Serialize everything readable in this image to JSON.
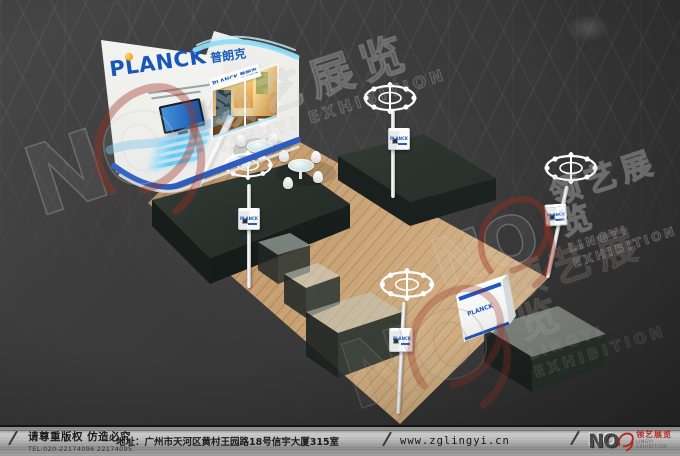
{
  "booth": {
    "brand": "PLANCK",
    "brand_cn": "普朗克"
  },
  "watermark": {
    "no": "NO",
    "one": "1",
    "cn": "领艺展览",
    "en": "LINGYI EXHIBITION"
  },
  "footer": {
    "copyright": "请尊重版权 仿造必究",
    "tel": "TEL:020-22174096 22174095",
    "address": "地址：广州市天河区黄村王园路18号信宇大厦315室",
    "website": "www.zglingyi.cn",
    "logo_no": "NO",
    "logo_cn": "领艺展览",
    "logo_en": "LINGYI EXHIBITION"
  },
  "colors": {
    "brand_blue": "#1857b8",
    "accent_orange": "#f0a31c",
    "led_cyan": "#59c6f2",
    "stripe_blue": "#2b5dc2",
    "watermark_red": "#9e3022",
    "floor_wood": "#c49c6d",
    "footer_silver": "#b4b4b4"
  }
}
